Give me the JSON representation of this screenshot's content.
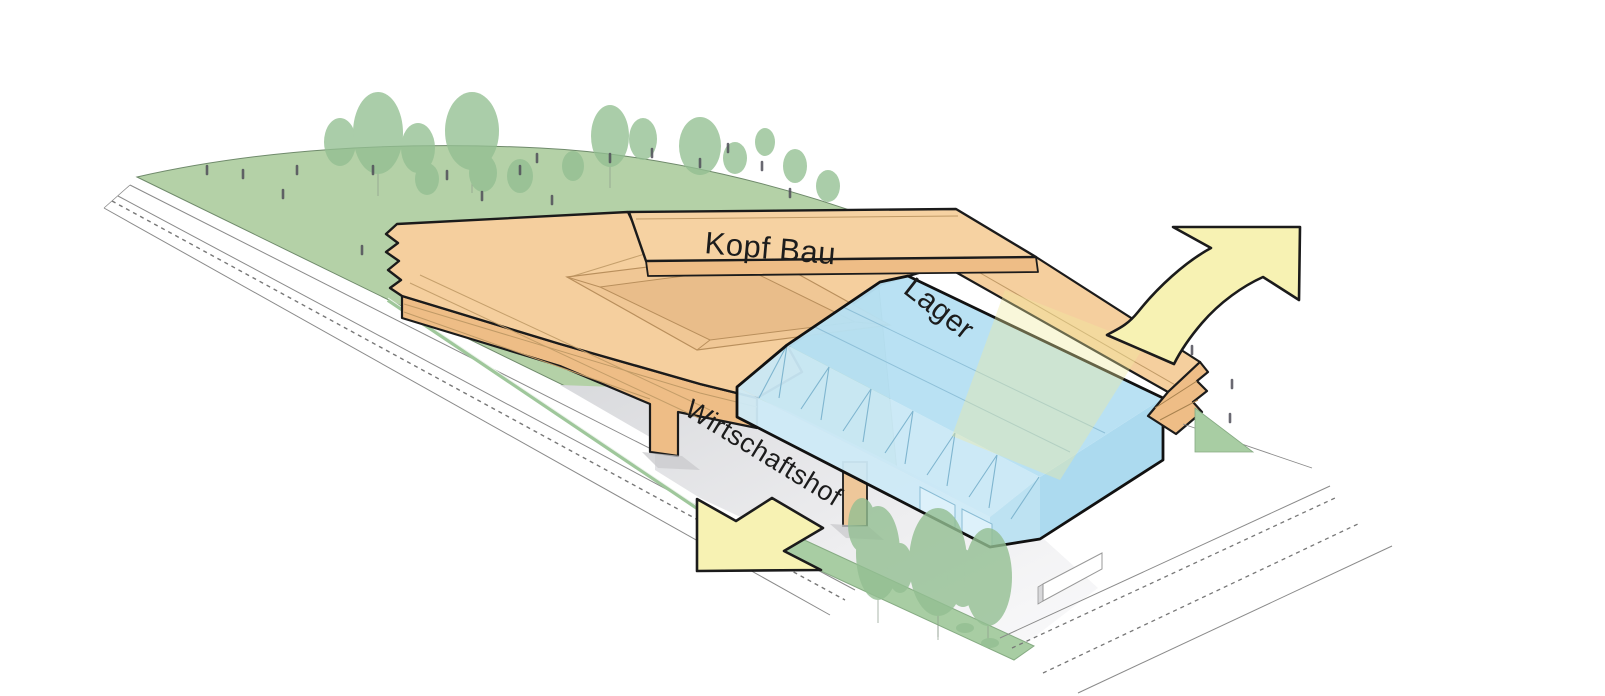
{
  "diagram": {
    "type": "axonometric-site-diagram",
    "labels": {
      "kopf_bau": "Kopf Bau",
      "lager": "Lager",
      "wirtschaftshof": "Wirtschaftshof"
    },
    "site_elements": [
      "Kopf Bau",
      "Lager",
      "Wirtschaftshof"
    ],
    "colors": {
      "building_orange": "#f5cf9e",
      "building_orange_shade": "#eebd86",
      "building_orange_line": "#c09a66",
      "lager_blue": "#b6e0f2",
      "lager_blue_light": "#c9e8f6",
      "lager_blue_dark": "#a9d9ee",
      "hill_green": "#b4d1a7",
      "tree_green": "#93bf92",
      "strip_green": "#a8cda3",
      "arrow_yellow": "#f7f2b3",
      "outline_dark": "#1b1b1b",
      "road_gray": "#8a8a8a",
      "yard_gray": "#dfe0e3",
      "figure_gray": "#4f4e58"
    }
  }
}
